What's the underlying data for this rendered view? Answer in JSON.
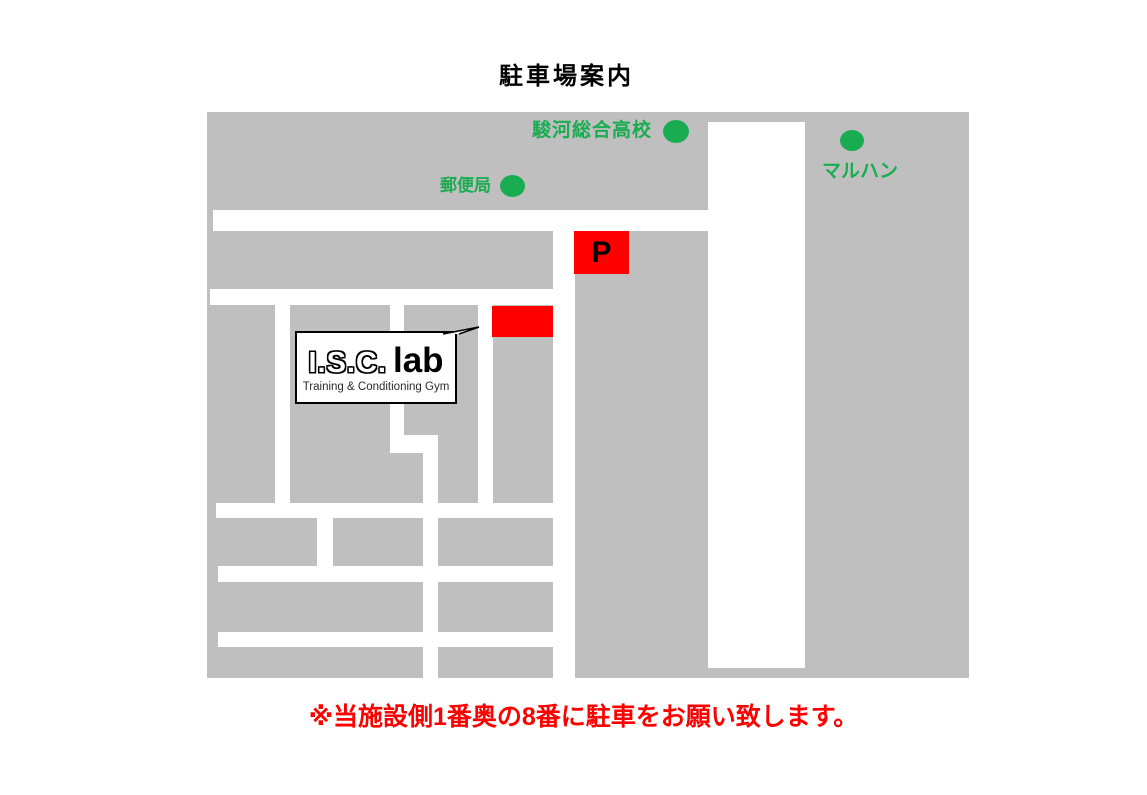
{
  "title": "駐車場案内",
  "map": {
    "landmarks": [
      {
        "label": "駿河総合高校"
      },
      {
        "label": "郵便局"
      },
      {
        "label": "マルハン"
      }
    ],
    "parking_marker": "P",
    "logo": {
      "name": "I.S.C.",
      "name_bold": "lab",
      "subtitle": "Training & Conditioning Gym"
    }
  },
  "note": "※当施設側1番奥の8番に駐車をお願い致します。",
  "colors": {
    "map_gray": "#BFBFBF",
    "road_white": "#FFFFFF",
    "landmark_green": "#1AAC50",
    "parking_red": "#FF0000",
    "note_red": "#FF0000"
  }
}
